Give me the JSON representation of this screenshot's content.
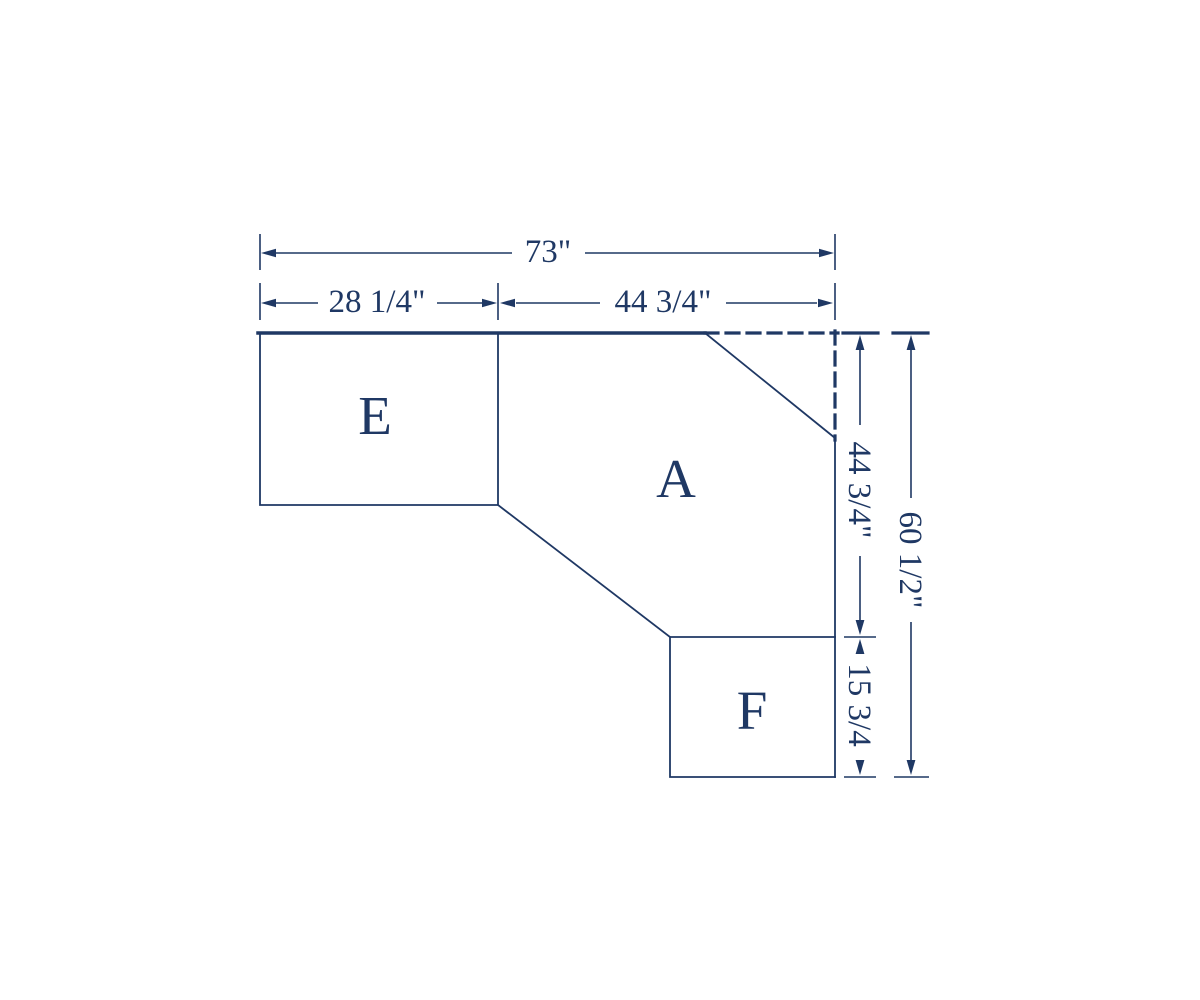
{
  "diagram": {
    "description": "Dimensioned plan drawing of an L-shaped corner worksurface made of three pieces",
    "colors": {
      "line": "#1f3864",
      "background": "#ffffff"
    },
    "pieces": [
      {
        "label": "E"
      },
      {
        "label": "A"
      },
      {
        "label": "F"
      }
    ],
    "dims": {
      "overall_width": "73\"",
      "left_section_width": "28 1/4\"",
      "right_section_width": "44 3/4\"",
      "upper_right_height": "44 3/4\"",
      "lower_right_height": "15 3/4",
      "overall_height": "60 1/2\""
    }
  }
}
